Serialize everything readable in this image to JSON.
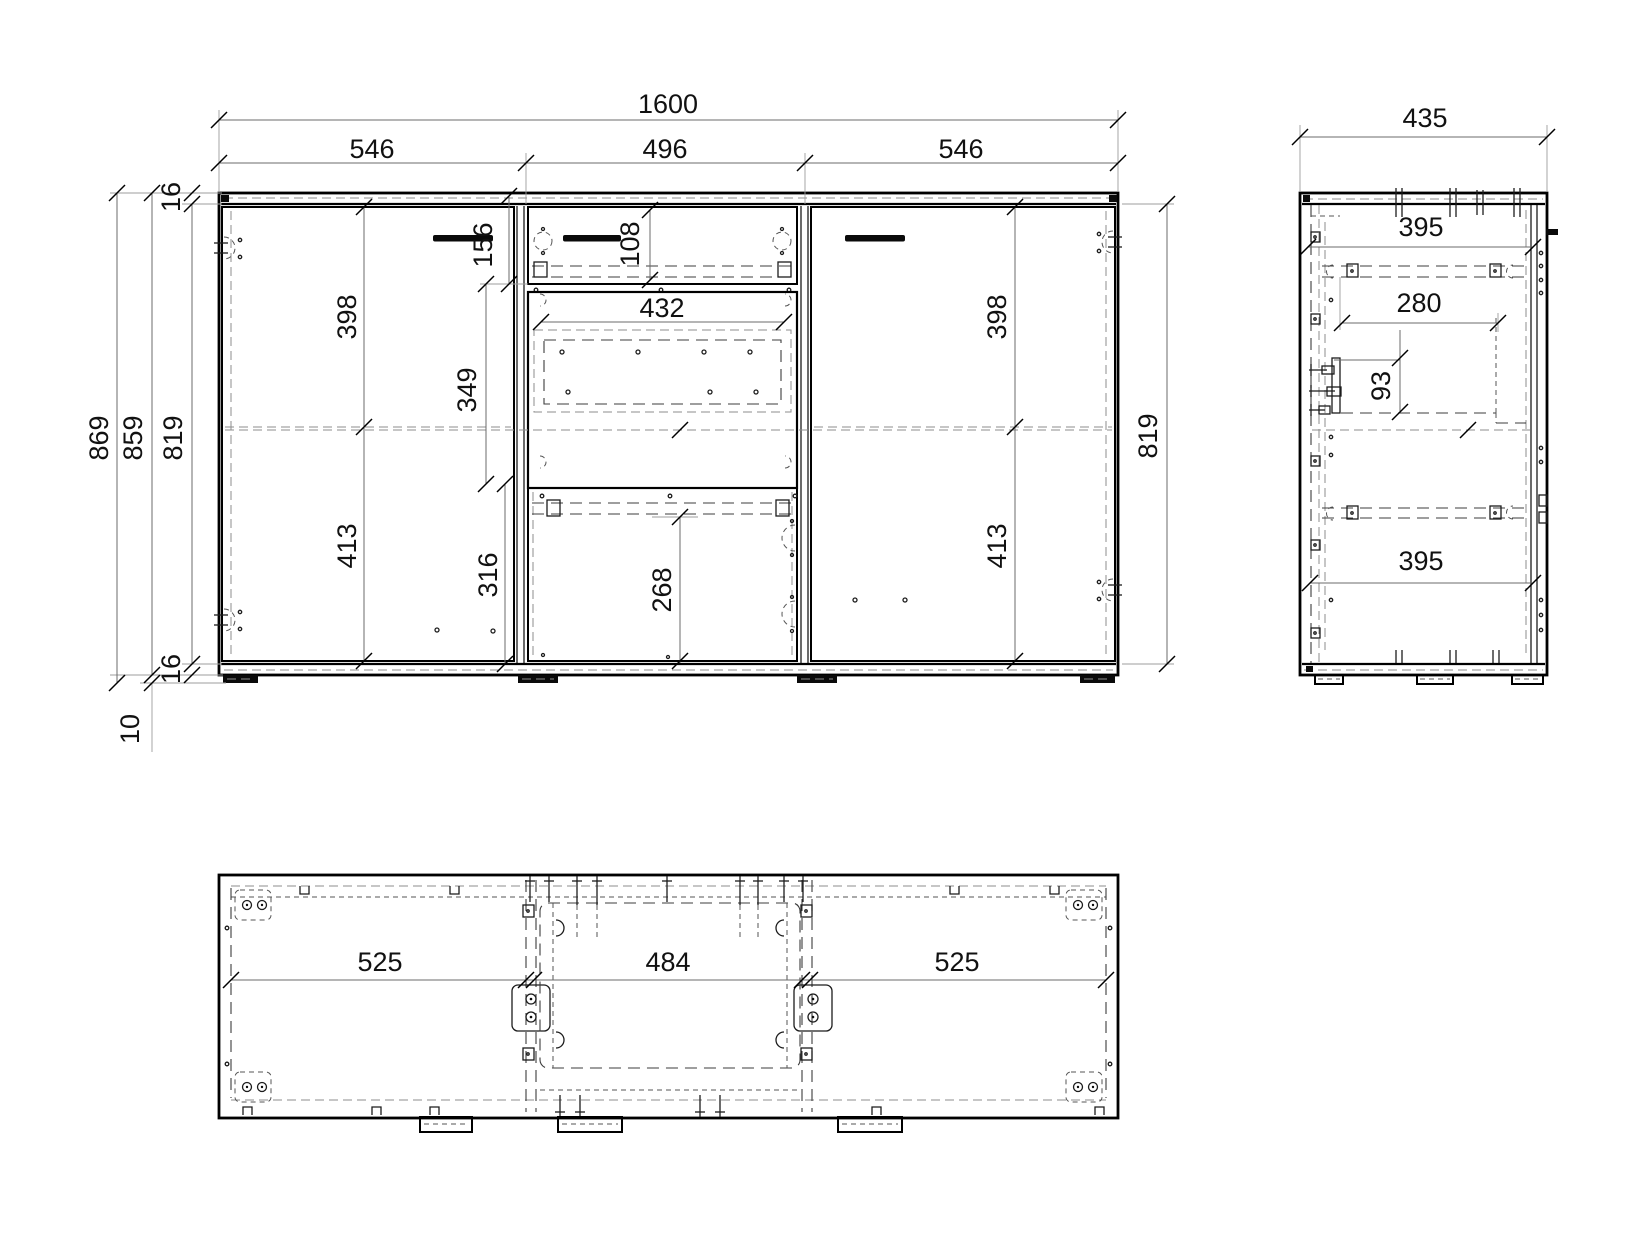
{
  "views": {
    "front": {
      "dims": {
        "total_width": "1600",
        "seg_left": "546",
        "seg_mid": "496",
        "seg_right": "546",
        "height_total": "869",
        "height_body": "859",
        "height_interior": "819",
        "top_thickness": "16",
        "bottom_thickness": "16",
        "feet_height": "10",
        "drawer_zone": "156",
        "drawer_front": "108",
        "shelf_width": "432",
        "open_height": "349",
        "left_door_upper": "398",
        "left_door_lower": "413",
        "right_door_upper": "398",
        "right_door_lower": "413",
        "lower_zone": "316",
        "lower_front": "268",
        "height_interior_right": "819"
      }
    },
    "side": {
      "dims": {
        "depth": "435",
        "top_depth": "395",
        "drawer_depth": "280",
        "drawer_side_height": "93",
        "bottom_depth": "395"
      }
    },
    "bottom": {
      "dims": {
        "seg_left": "525",
        "seg_mid": "484",
        "seg_right": "525"
      }
    }
  }
}
